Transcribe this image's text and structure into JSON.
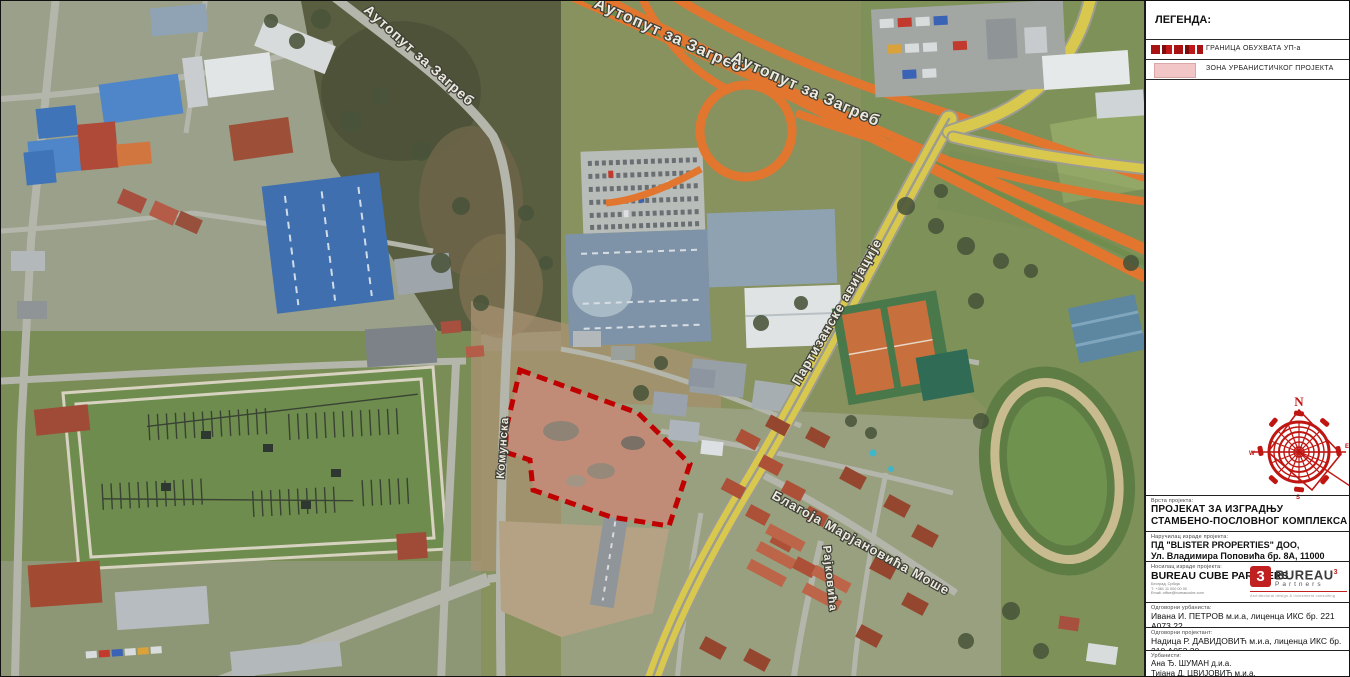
{
  "legend": {
    "title": "ЛЕГЕНДА:",
    "items": [
      {
        "label": "ГРАНИЦА ОБУХВАТА УП-а"
      },
      {
        "label": "ЗОНА УРБАНИСТИЧКОГ ПРОЈЕКТА"
      }
    ]
  },
  "compass": {
    "north": "N",
    "west": "W",
    "east": "E",
    "south": "S"
  },
  "map_labels": {
    "highway_a": "Аутопут за Загреб",
    "highway_b": "Аутопут за Загреб",
    "highway_c": "Аутопут за Загреб",
    "partizanske": "Партизанске авијације",
    "blagoja": "Благоја Марјановића Моше",
    "rajkovica": "Рајковића",
    "komunska": "Комунска"
  },
  "titleblock": {
    "project_type_label": "Врста пројекта:",
    "project_title_line1": "ПРОЈЕКАТ ЗА ИЗГРАДЊУ",
    "project_title_line2": "СТАМБЕНО-ПОСЛОВНОГ КОМПЛЕКСА",
    "client_label": "Наручилац израде пројекта:",
    "client_line1": "ПД \"BLISTER PROPERTIES\" ДОО,",
    "client_line2": "Ул. Владимира Поповића бр. 8А, 11000 Београд",
    "author_label": "Носилац израде пројекта:",
    "author_company": "BUREAU CUBE PARTNERS",
    "author_addr1": "Београд, Србија",
    "author_addr2": "Т: +381 11 000 00 00",
    "author_addr3": "Email: office@bureaucube.com",
    "urbanist_label": "Одговорни урбаниста:",
    "urbanist_value": "Ивана И. ПЕТРОВ м.и.а, лиценца ИКС бр. 221 А073 22",
    "designer_label": "Одговорни пројектант:",
    "designer_value": "Надица Р. ДАВИДОВИЋ м.и.а, лиценца ИКС бр. 210 А053 20",
    "team_label": "Урбанисти:",
    "team": [
      "Ана Ђ. ШУМАН д.и.а.",
      "Тијана Д. ЦВИЈОВИЋ м.и.а.",
      "Марија Л. МИЧИЈЕВИЋ д.и.а."
    ]
  },
  "logo": {
    "mark": "3",
    "name": "BUREAU",
    "sup": "3",
    "subname": "Partners",
    "tagline": "Architectural design & investment consulting"
  },
  "colors": {
    "boundary_red": "#c00000",
    "zone_pink": "#f2c6c6",
    "compass_red": "#bf1612",
    "highway_orange": "#e2762f",
    "road_yellow": "#d9c84e"
  }
}
